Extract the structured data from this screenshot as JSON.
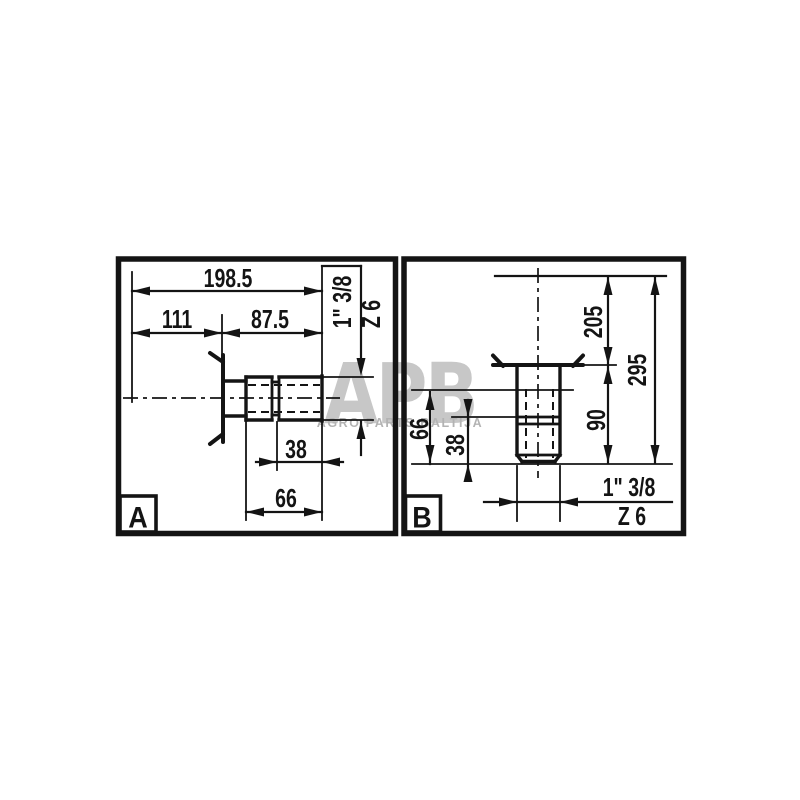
{
  "colors": {
    "line": "#141414",
    "watermark_logo": "#c7c7c7",
    "watermark_text": "#b3b3b3"
  },
  "watermark": {
    "logo": "APB",
    "subtitle": "AGRO PARTS BALTIJA"
  },
  "panel_a": {
    "label": "A",
    "dim_total_length": "198.5",
    "dim_left_length": "111",
    "dim_right_length": "87.5",
    "dim_spline_38": "38",
    "dim_spline_66": "66",
    "spline_size": "1\" 3/8",
    "spline_teeth": "Z 6"
  },
  "panel_b": {
    "label": "B",
    "dim_height_205": "205",
    "dim_height_295": "295",
    "dim_height_90": "90",
    "dim_spline_66": "66",
    "dim_spline_38": "38",
    "spline_size": "1\" 3/8",
    "spline_teeth": "Z 6"
  }
}
